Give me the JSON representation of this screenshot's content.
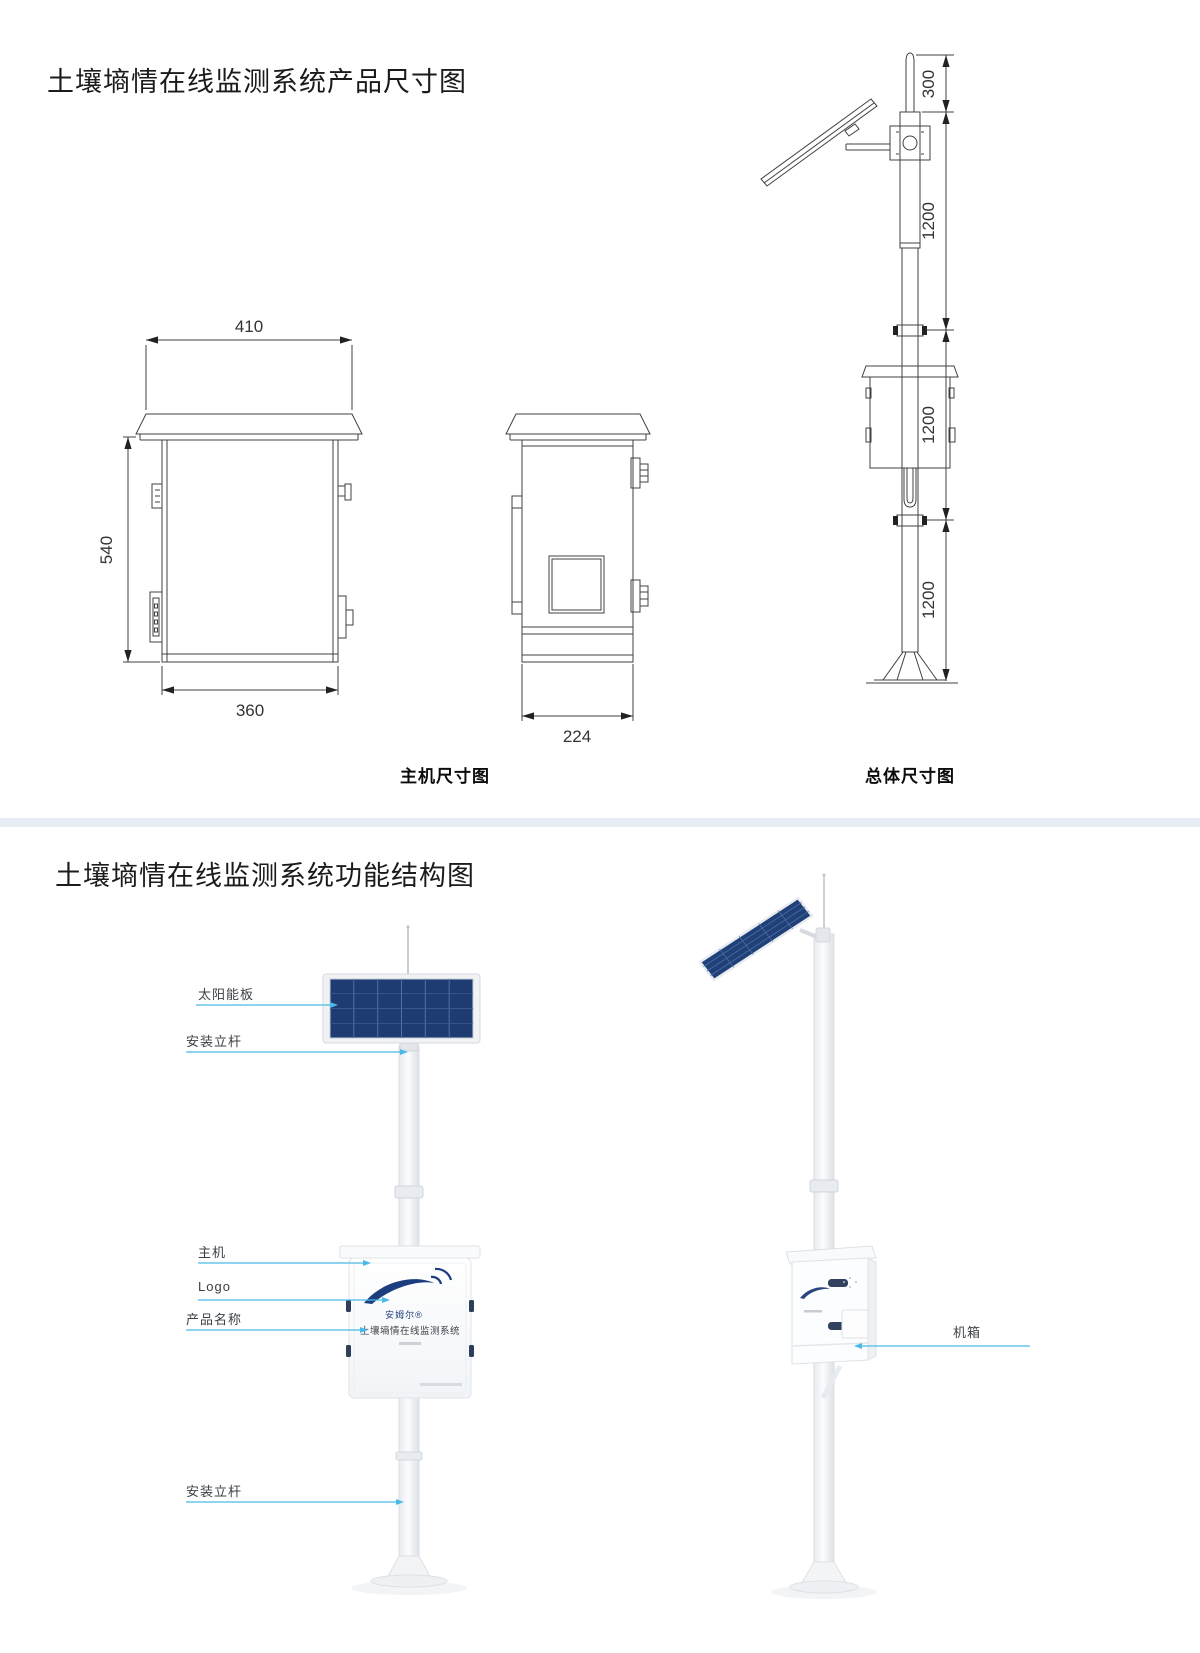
{
  "titles": {
    "dimensions": "土壤墒情在线监测系统产品尺寸图",
    "structure": "土壤墒情在线监测系统功能结构图"
  },
  "dimension_diagram": {
    "captions": {
      "main_unit": "主机尺寸图",
      "overall": "总体尺寸图"
    },
    "front_view": {
      "top_width": "410",
      "height": "540",
      "bottom_width": "360"
    },
    "side_view": {
      "depth": "224"
    },
    "overall_view": {
      "antenna": "300",
      "upper": "1200",
      "middle": "1200",
      "lower": "1200"
    }
  },
  "structure_diagram": {
    "callouts": {
      "solar_panel": "太阳能板",
      "pole_upper": "安装立杆",
      "main_unit": "主机",
      "logo": "Logo",
      "product_name": "产品名称",
      "pole_lower": "安装立杆",
      "cabinet": "机箱"
    },
    "device": {
      "brand": "安姆尔®",
      "product_name": "土壤墒情在线监测系统"
    }
  },
  "colors": {
    "leader_line": "#4ab9e8",
    "divider_band": "#e8eef5",
    "solar_panel_blue": "#1e3c72",
    "logo_navy": "#1d3e7e",
    "drawing_stroke": "#404040"
  }
}
